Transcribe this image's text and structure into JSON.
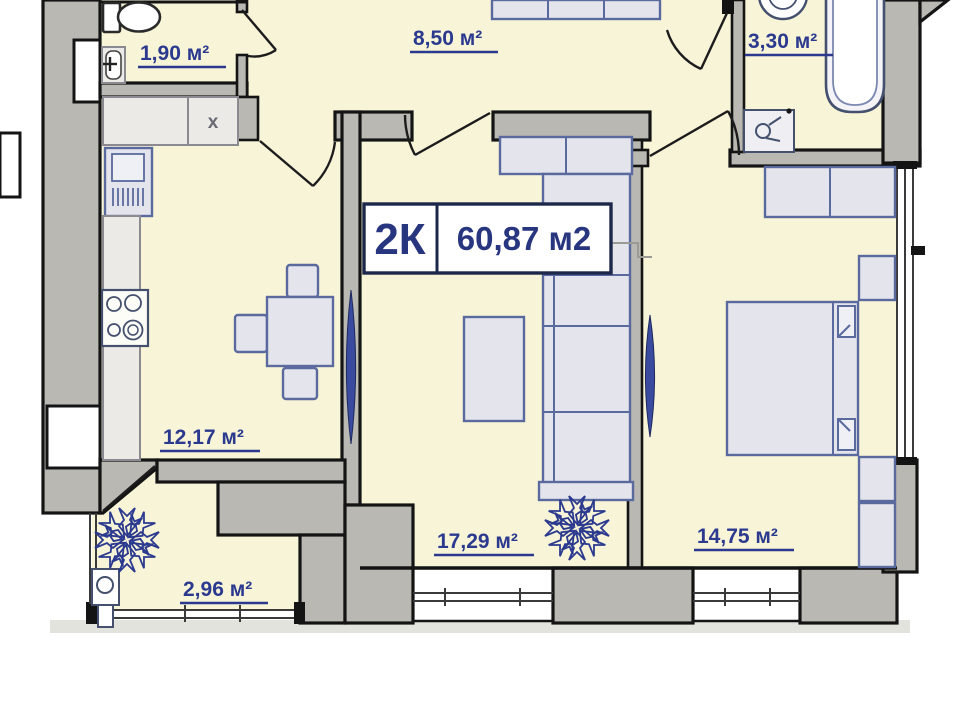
{
  "plan_title": {
    "type_label": "2К",
    "total_area": "60,87 м2"
  },
  "rooms": {
    "wc": {
      "name": "wc",
      "area": "1,90 м²"
    },
    "hall": {
      "name": "hallway",
      "area": "8,50 м²"
    },
    "bath": {
      "name": "bathroom",
      "area": "3,30 м²"
    },
    "kitchen": {
      "name": "kitchen",
      "area": "12,17 м²",
      "cabinet_mark": "x"
    },
    "living": {
      "name": "living-room",
      "area": "17,29 м²"
    },
    "bedroom": {
      "name": "bedroom",
      "area": "14,75 м²"
    },
    "balcony": {
      "name": "balcony",
      "area": "2,96 м²"
    }
  },
  "colors": {
    "floor_fill": "#f8f4d7",
    "wall_fill": "#b9b8b2",
    "accent_text": "#2b3a8f",
    "furniture_outline": "#5a6a9e",
    "radiator": "#3a4a9e"
  }
}
